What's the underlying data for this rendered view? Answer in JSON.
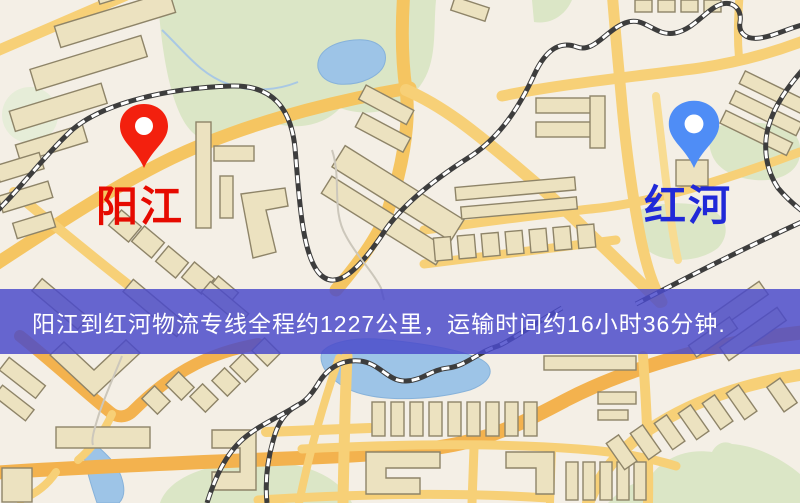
{
  "banner": {
    "text": "阳江到红河物流专线全程约1227公里，运输时间约16小时36分钟.",
    "background_color": "#4a4aca",
    "text_color": "#ffffff"
  },
  "markers": {
    "origin": {
      "label": "阳江",
      "label_color": "#e60a00",
      "pin_color": "#f3200e",
      "pin_icon": "map-pin"
    },
    "destination": {
      "label": "红河",
      "label_color": "#2029d8",
      "pin_color": "#4f8df6",
      "pin_icon": "map-pin"
    }
  },
  "map": {
    "colors": {
      "background": "#f4efe6",
      "park": "#dbe6c6",
      "water": "#9dc4e7",
      "road": "#f7d077",
      "road_major": "#f3b24e",
      "building": "#ece2c0",
      "railway": "#3d3d3d"
    }
  }
}
